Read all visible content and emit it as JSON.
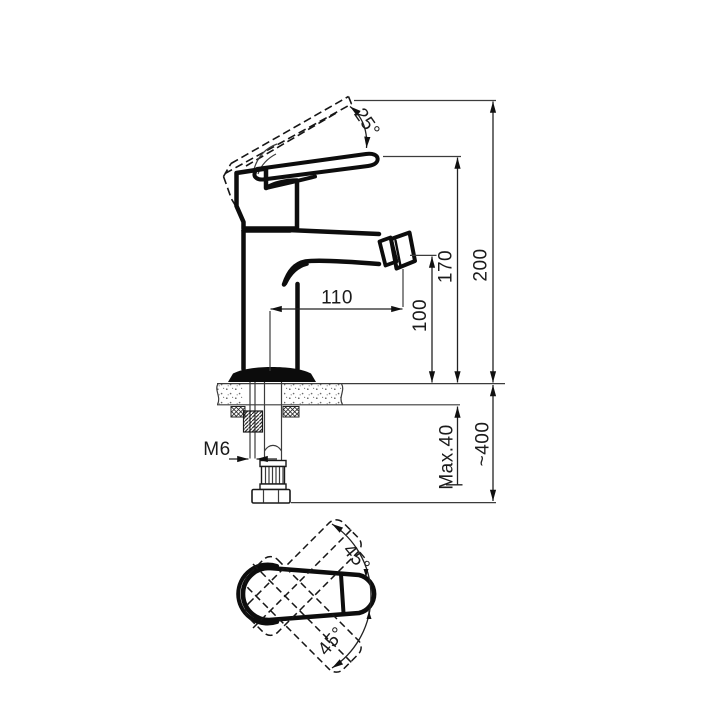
{
  "drawing": {
    "type": "technical-dimension-drawing",
    "subject": "single-lever bidet mixer tap — side elevation with mounting section and plan view of handle",
    "background": "#ffffff",
    "line_color": "#0d0d0d",
    "side_view": {
      "handle_tilt_angle": "25°",
      "overall_height": "200",
      "handle_tip_height": "170",
      "spout_reach": "110",
      "aerator_height": "100",
      "fixing_stud_thread": "M6",
      "max_deck_thickness": "Max.40",
      "hose_length": "~400"
    },
    "top_view": {
      "handle_swing_up": "45°",
      "handle_swing_down": "45°"
    }
  }
}
